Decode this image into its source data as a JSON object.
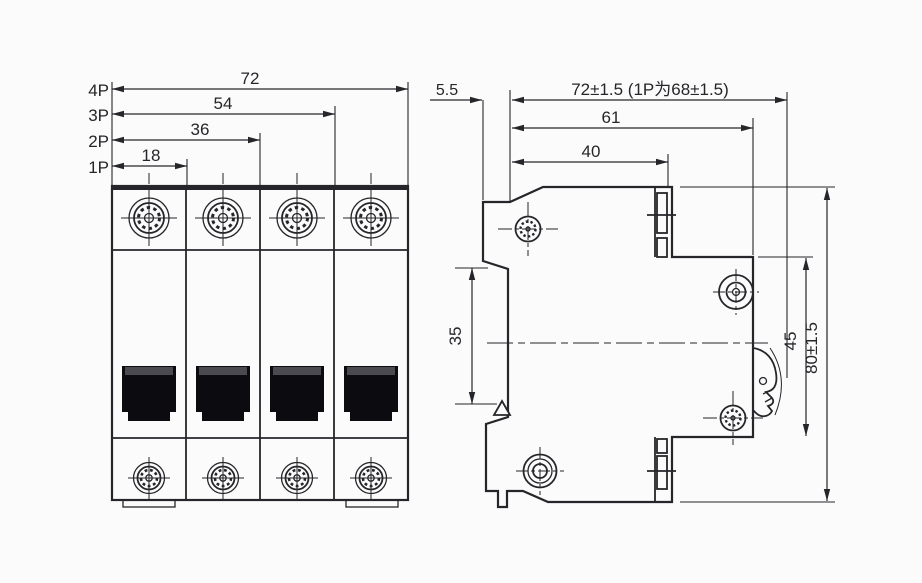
{
  "front_view": {
    "dimensions": [
      {
        "pole_label": "4P",
        "value": "72"
      },
      {
        "pole_label": "3P",
        "value": "54"
      },
      {
        "pole_label": "2P",
        "value": "36"
      },
      {
        "pole_label": "1P",
        "value": "18"
      }
    ]
  },
  "side_view": {
    "dimensions": {
      "hook_depth": "5.5",
      "overall_depth": "72±1.5 (1P为68±1.5)",
      "body_depth": "61",
      "upper_depth": "40",
      "rail_section_height": "35",
      "front_section_height": "45",
      "overall_height": "80±1.5"
    }
  },
  "colors": {
    "line": "#26262a",
    "handle": "#0b0b10",
    "handle_cap": "#4a4a50",
    "background": "#fbfbfb"
  }
}
